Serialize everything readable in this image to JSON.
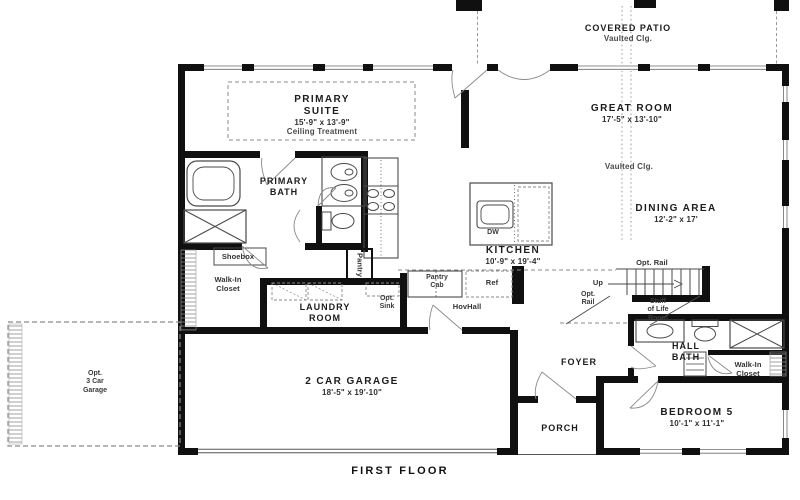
{
  "plan": {
    "footer": "FIRST FLOOR",
    "colors": {
      "wall": "#101010",
      "thin_line": "#555555",
      "dashed": "#8a8a8a",
      "text": "#1c1c1c"
    },
    "rooms": {
      "covered_patio": {
        "name": "COVERED PATIO",
        "note": "Vaulted Clg."
      },
      "primary_suite": {
        "l1": "PRIMARY",
        "l2": "SUITE",
        "dims": "15'-9\" x 13'-9\"",
        "note": "Ceiling Treatment"
      },
      "great_room": {
        "name": "GREAT ROOM",
        "dims": "17'-5\" x 13'-10\"",
        "note": "Vaulted Clg."
      },
      "dining_area": {
        "name": "DINING AREA",
        "dims": "12'-2\" x 17'"
      },
      "primary_bath": {
        "l1": "PRIMARY",
        "l2": "BATH"
      },
      "kitchen": {
        "name": "KITCHEN",
        "dims": "10'-9\" x 19'-4\""
      },
      "laundry_room": {
        "l1": "LAUNDRY",
        "l2": "ROOM"
      },
      "walk_in_closet_primary": {
        "l1": "Walk-In",
        "l2": "Closet"
      },
      "shoebox": {
        "name": "Shoebox"
      },
      "pantry": {
        "name": "Pantry"
      },
      "pantry_cab": {
        "l1": "Pantry",
        "l2": "Cab"
      },
      "fridge": {
        "name": "Ref"
      },
      "hov_hall": {
        "name": "HovHall"
      },
      "opt_sink": {
        "l1": "Opt.",
        "l2": "Sink"
      },
      "dishwasher": {
        "name": "DW"
      },
      "opt_rail_top": {
        "name": "Opt. Rail"
      },
      "opt_rail_side": {
        "l1": "Opt.",
        "l2": "Rail"
      },
      "stairs_up": {
        "name": "Up"
      },
      "stuff_of_life": {
        "l1": "Stuff",
        "l2": "of Life",
        "l3": "Room"
      },
      "foyer": {
        "name": "FOYER"
      },
      "hall_bath": {
        "l1": "HALL",
        "l2": "BATH"
      },
      "walk_in_closet_bed5": {
        "l1": "Walk-In",
        "l2": "Closet"
      },
      "bedroom5": {
        "name": "BEDROOM 5",
        "dims": "10'-1\" x 11'-1\""
      },
      "porch": {
        "name": "PORCH"
      },
      "garage": {
        "name": "2 CAR GARAGE",
        "dims": "18'-5\" x 19'-10\""
      },
      "opt_3car_garage": {
        "l1": "Opt.",
        "l2": "3 Car",
        "l3": "Garage"
      }
    }
  }
}
